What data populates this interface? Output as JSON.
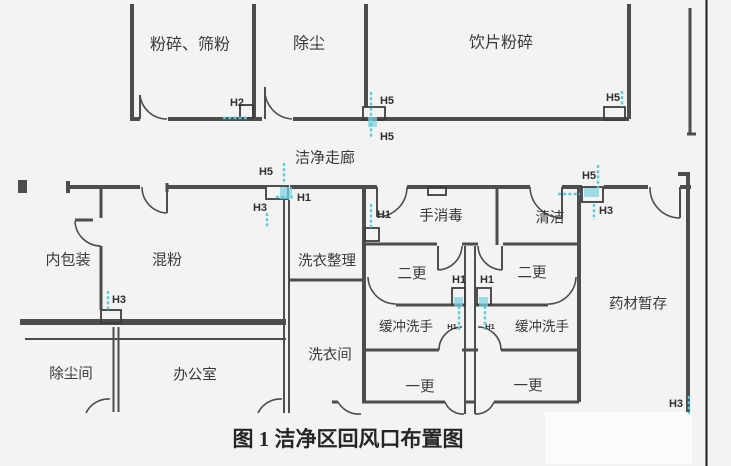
{
  "figure": {
    "caption": "图 1 洁净区回风口布置图"
  },
  "corridor": {
    "label": "洁净走廊"
  },
  "rooms": [
    {
      "name": "crushing-sieving",
      "label": "粉碎、筛粉"
    },
    {
      "name": "dust-removal",
      "label": "除尘"
    },
    {
      "name": "decoction-crushing",
      "label": "饮片粉碎"
    },
    {
      "name": "inner-packaging",
      "label": "内包装"
    },
    {
      "name": "powder-mixing",
      "label": "混粉"
    },
    {
      "name": "laundry-sorting",
      "label": "洗衣整理"
    },
    {
      "name": "hand-disinfection",
      "label": "手消毒"
    },
    {
      "name": "cleaning",
      "label": "清洁"
    },
    {
      "name": "second-change-left",
      "label": "二更"
    },
    {
      "name": "second-change-right",
      "label": "二更"
    },
    {
      "name": "buffer-handwash-left",
      "label": "缓冲洗手"
    },
    {
      "name": "buffer-handwash-right",
      "label": "缓冲洗手"
    },
    {
      "name": "herb-storage",
      "label": "药材暂存"
    },
    {
      "name": "laundry-room",
      "label": "洗衣间"
    },
    {
      "name": "dust-room",
      "label": "除尘间"
    },
    {
      "name": "office",
      "label": "办公室"
    },
    {
      "name": "first-change-left",
      "label": "一更"
    },
    {
      "name": "first-change-right",
      "label": "一更"
    }
  ],
  "markers": [
    {
      "name": "h2-crushing",
      "label": "H2"
    },
    {
      "name": "h5-top-wall-above",
      "label": "H5"
    },
    {
      "name": "h5-top-wall-below",
      "label": "H5"
    },
    {
      "name": "h5-decoction-right",
      "label": "H5"
    },
    {
      "name": "h5-corridor-left",
      "label": "H5"
    },
    {
      "name": "h1-corridor-left",
      "label": "H1"
    },
    {
      "name": "h3-corridor-left",
      "label": "H3"
    },
    {
      "name": "h5-corridor-right",
      "label": "H5"
    },
    {
      "name": "h3-corridor-right",
      "label": "H3"
    },
    {
      "name": "h1-hand-disinfection",
      "label": "H1"
    },
    {
      "name": "h3-powder-mixing",
      "label": "H3"
    },
    {
      "name": "h1-center-left",
      "label": "H1"
    },
    {
      "name": "h1-center-right",
      "label": "H1"
    },
    {
      "name": "h1-buffer-left",
      "label": "H1"
    },
    {
      "name": "h1-buffer-right",
      "label": "H1"
    },
    {
      "name": "h3-herb-storage",
      "label": "H3"
    }
  ],
  "colors": {
    "wall": "#4d4d4d",
    "marker_cyan": "#55c6d8",
    "marker_cyan_fill": "#7bd2e0",
    "label_text": "#3a3a3a",
    "caption_text": "#262626",
    "frame_line": "#1c1c1c",
    "background": "#f3f3f1"
  }
}
